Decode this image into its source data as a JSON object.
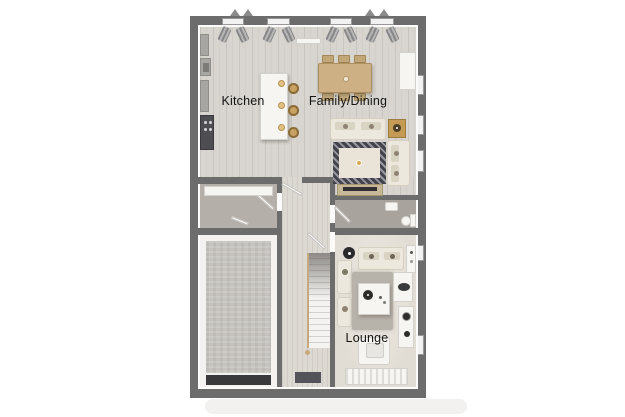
{
  "floorplan": {
    "background_color": "#ffffff",
    "wall_color": "#6c6c6c",
    "rooms": [
      {
        "id": "kitchen",
        "label": "Kitchen"
      },
      {
        "id": "family-dining",
        "label": "Family/Dining"
      },
      {
        "id": "lounge",
        "label": "Lounge"
      }
    ]
  }
}
